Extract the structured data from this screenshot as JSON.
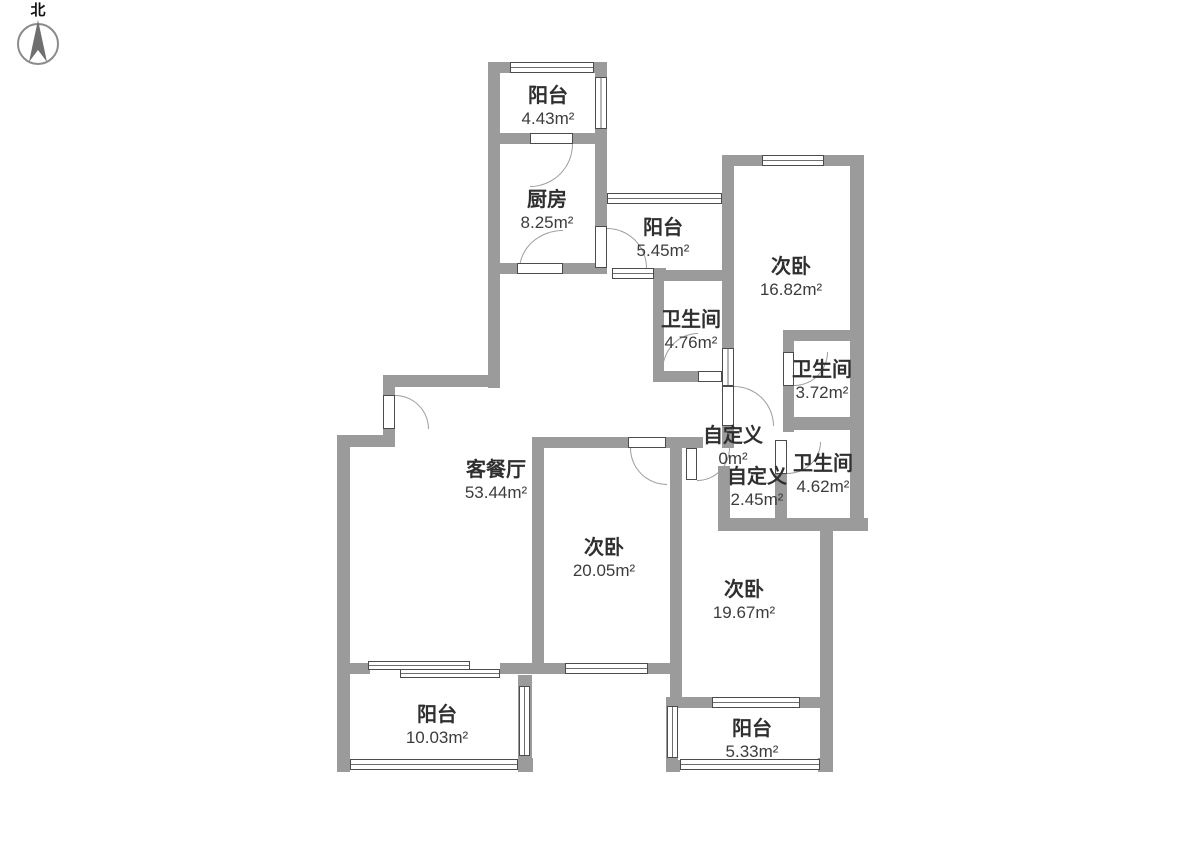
{
  "compass": {
    "label": "北"
  },
  "rooms": [
    {
      "id": "balcony-north",
      "name": "阳台",
      "area": "4.43m²"
    },
    {
      "id": "kitchen",
      "name": "厨房",
      "area": "8.25m²"
    },
    {
      "id": "balcony-service",
      "name": "阳台",
      "area": "5.45m²"
    },
    {
      "id": "bedroom-northeast",
      "name": "次卧",
      "area": "16.82m²"
    },
    {
      "id": "bathroom-middle",
      "name": "卫生间",
      "area": "4.76m²"
    },
    {
      "id": "bathroom-upper",
      "name": "卫生间",
      "area": "3.72m²"
    },
    {
      "id": "custom-zero",
      "name": "自定义",
      "area": "0m²"
    },
    {
      "id": "custom-hall",
      "name": "自定义",
      "area": "2.45m²"
    },
    {
      "id": "bathroom-lower",
      "name": "卫生间",
      "area": "4.62m²"
    },
    {
      "id": "living-dining",
      "name": "客餐厅",
      "area": "53.44m²"
    },
    {
      "id": "bedroom-middle",
      "name": "次卧",
      "area": "20.05m²"
    },
    {
      "id": "bedroom-southeast",
      "name": "次卧",
      "area": "19.67m²"
    },
    {
      "id": "balcony-southwest",
      "name": "阳台",
      "area": "10.03m²"
    },
    {
      "id": "balcony-south",
      "name": "阳台",
      "area": "5.33m²"
    }
  ]
}
